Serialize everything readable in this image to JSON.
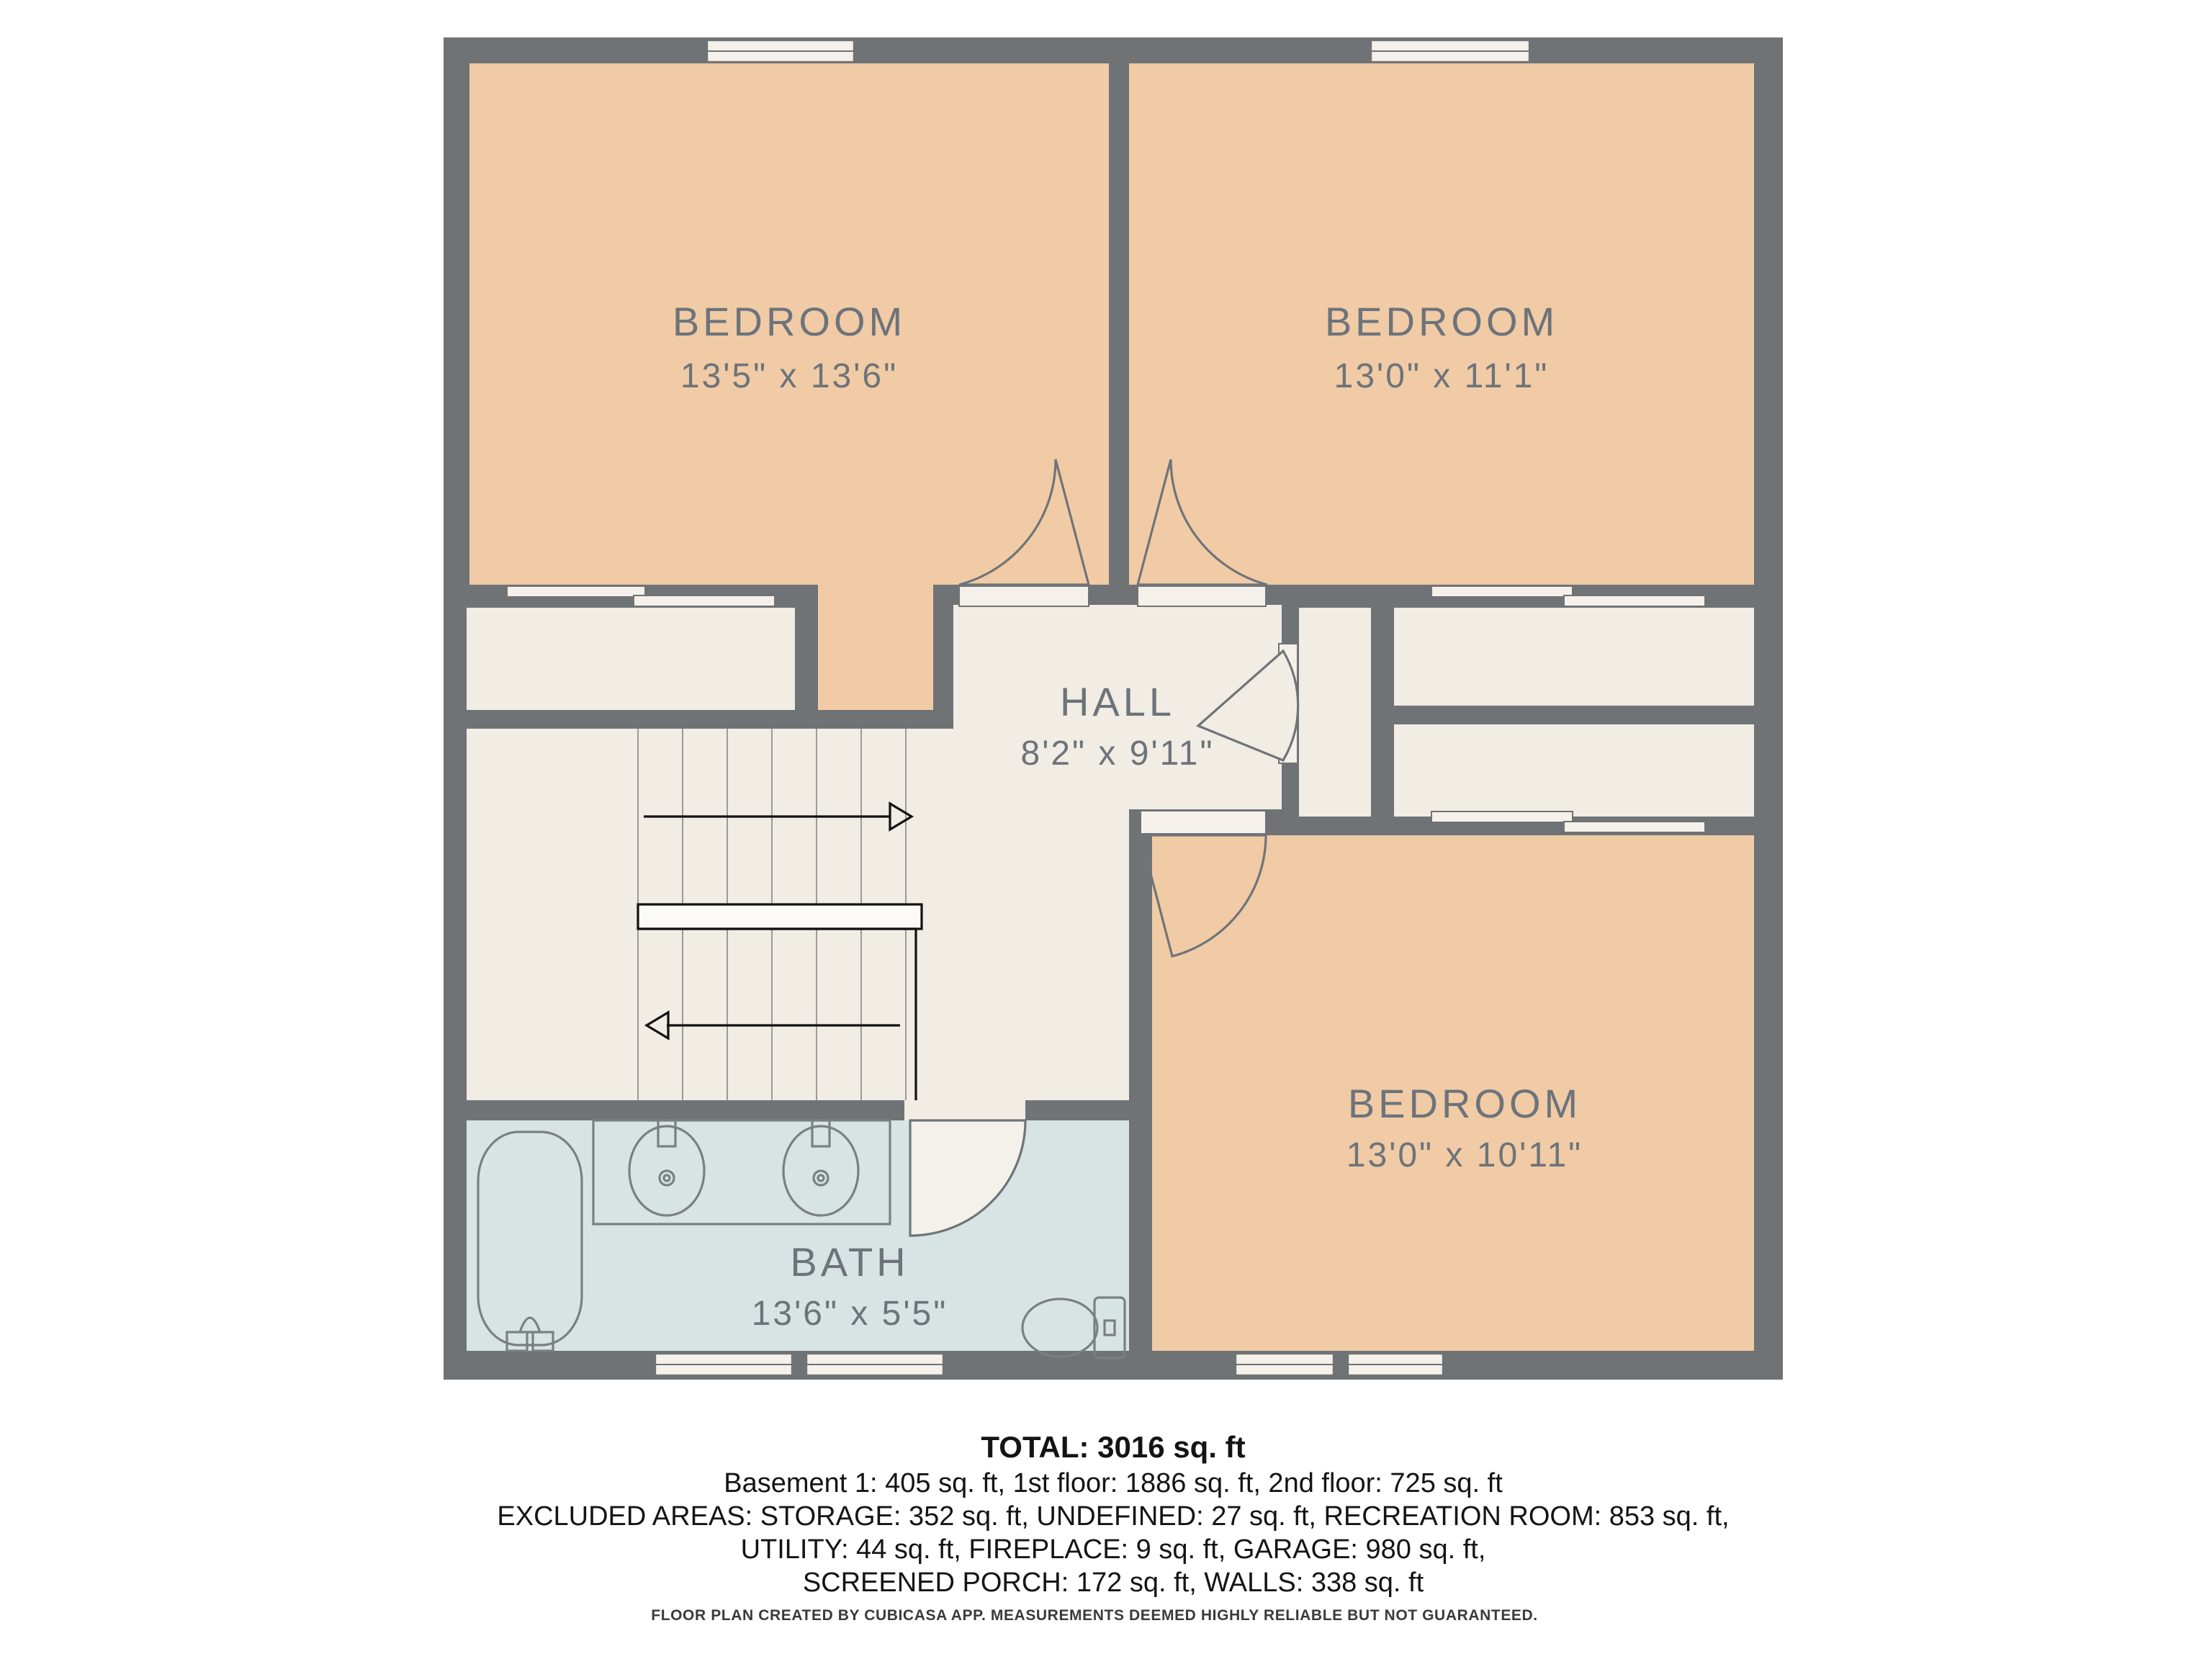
{
  "plan": {
    "rooms": [
      {
        "id": "bedroom-top-left",
        "label": "BEDROOM",
        "dims": "13'5\" x 13'6\""
      },
      {
        "id": "bedroom-top-right",
        "label": "BEDROOM",
        "dims": "13'0\" x 11'1\""
      },
      {
        "id": "hall",
        "label": "HALL",
        "dims": "8'2\" x 9'11\""
      },
      {
        "id": "bedroom-bottom",
        "label": "BEDROOM",
        "dims": "13'0\" x 10'11\""
      },
      {
        "id": "bath",
        "label": "BATH",
        "dims": "13'6\" x 5'5\""
      }
    ],
    "colors": {
      "wall": "#6f7376",
      "bedroom_fill": "#f0cba6",
      "hall_fill": "#f1ece4",
      "bath_fill": "#d7e4e3",
      "threshold": "#f5f1ea",
      "label_text": "#6d737a"
    },
    "icons": [
      "bathtub-icon",
      "sink-icon",
      "sink-icon",
      "toilet-icon",
      "stairs-up-arrow-icon",
      "stairs-down-arrow-icon"
    ]
  },
  "summary": {
    "total": "TOTAL: 3016 sq. ft",
    "floors": "Basement 1: 405 sq. ft, 1st floor: 1886 sq. ft, 2nd floor: 725 sq. ft",
    "excluded_line1": "EXCLUDED AREAS: STORAGE: 352 sq. ft, UNDEFINED: 27 sq. ft, RECREATION ROOM: 853 sq. ft,",
    "excluded_line2": "UTILITY: 44 sq. ft, FIREPLACE: 9 sq. ft, GARAGE: 980 sq. ft,",
    "excluded_line3": "SCREENED PORCH: 172 sq. ft, WALLS: 338 sq. ft"
  },
  "footer": "FLOOR PLAN CREATED BY CUBICASA APP. MEASUREMENTS DEEMED HIGHLY RELIABLE BUT NOT GUARANTEED."
}
